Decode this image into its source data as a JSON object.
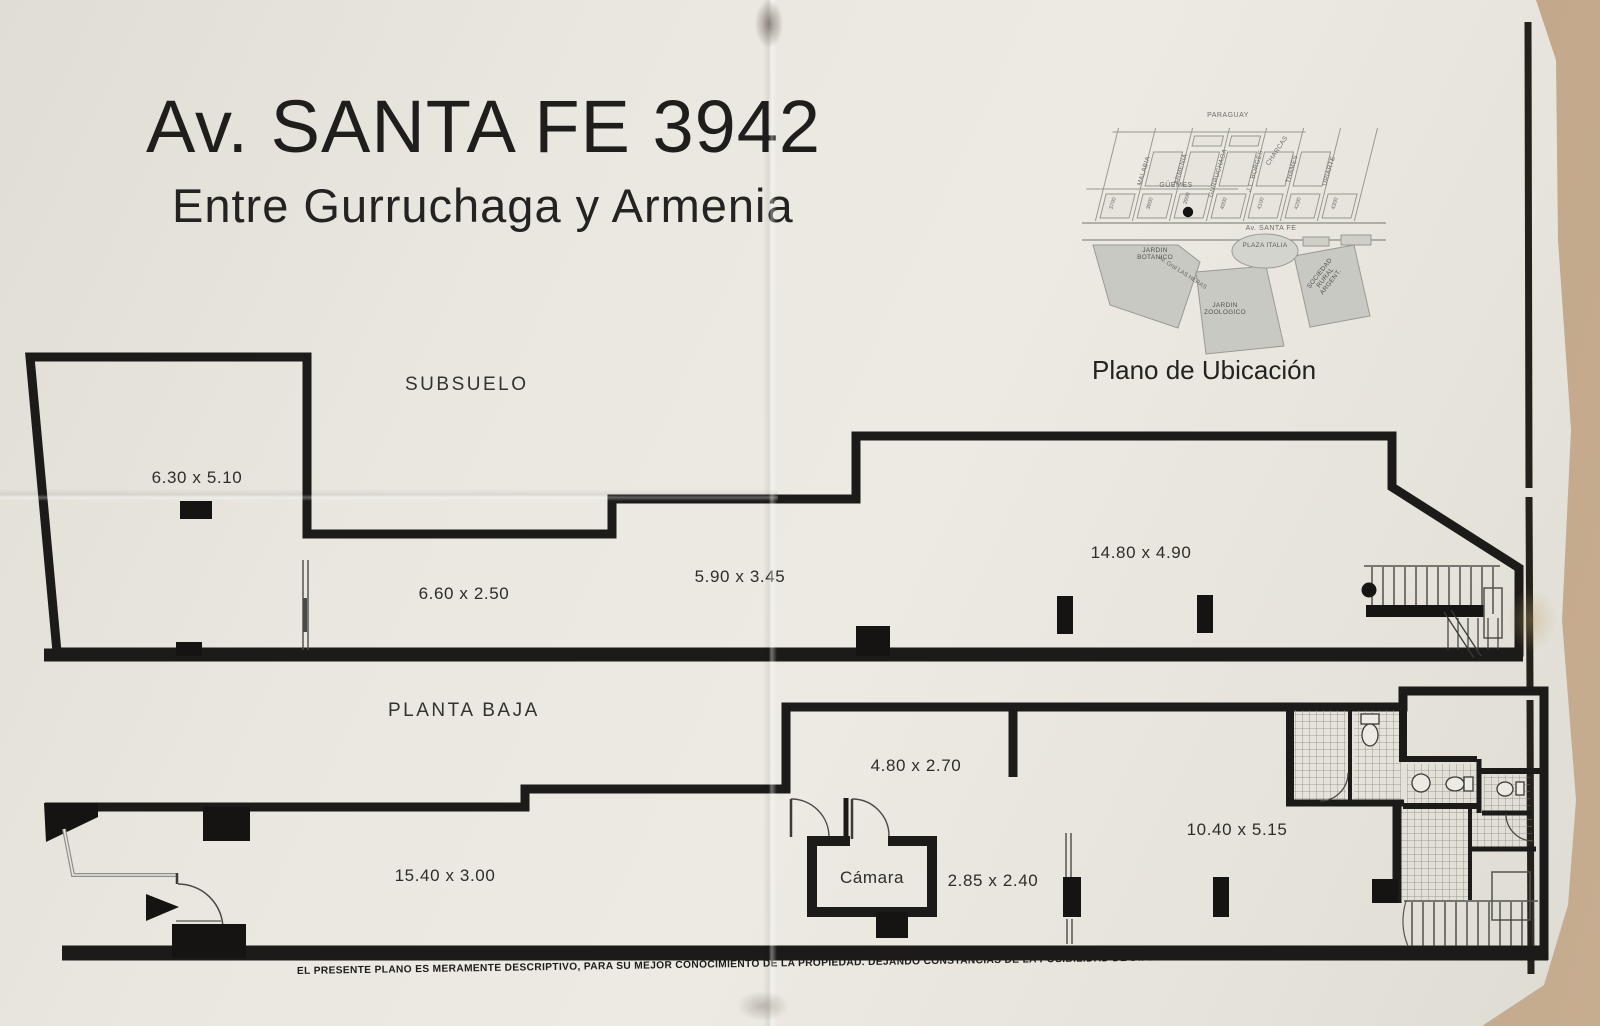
{
  "title": {
    "line1": "Av. SANTA FE 3942",
    "line2": "Entre Gurruchaga y Armenia"
  },
  "map": {
    "caption": "Plano de Ubicación",
    "h_streets": [
      {
        "label": "PARAGUAY"
      },
      {
        "label": "GÜEMES"
      },
      {
        "label": "CHARCAS"
      },
      {
        "label": "Av. SANTA FE"
      }
    ],
    "d_streets": [
      {
        "label": "MALABIA"
      },
      {
        "label": "ARMENIA"
      },
      {
        "label": "GURRUCHAGA"
      },
      {
        "label": "J.L. BORGES"
      },
      {
        "label": "THAMES"
      },
      {
        "label": "URIARTE"
      }
    ],
    "blocks": [
      {
        "num": "3700"
      },
      {
        "num": "3800"
      },
      {
        "num": "3900"
      },
      {
        "num": "4000"
      },
      {
        "num": "4100"
      },
      {
        "num": "4200"
      },
      {
        "num": "4300"
      }
    ],
    "landmarks": {
      "plaza": "PLAZA ITALIA",
      "botanico": "JARDIN BOTANICO",
      "zoologico": "JARDIN ZOOLOGICO",
      "rural": "SOCIEDAD RURAL ARGENT.",
      "las_heras": "Av. Gral LAS HERAS"
    }
  },
  "floors": {
    "subsuelo": {
      "label": "SUBSUELO",
      "dims": [
        {
          "label": "6.30 x 5.10"
        },
        {
          "label": "6.60 x 2.50"
        },
        {
          "label": "5.90 x 3.45"
        },
        {
          "label": "14.80 x 4.90"
        }
      ]
    },
    "planta_baja": {
      "label": "PLANTA BAJA",
      "room": "Cámara",
      "dims": [
        {
          "label": "15.40 x 3.00"
        },
        {
          "label": "4.80 x 2.70"
        },
        {
          "label": "2.85 x 2.40"
        },
        {
          "label": "10.40 x 5.15"
        }
      ]
    }
  },
  "disclaimer": "EL PRESENTE PLANO ES MERAMENTE DESCRIPTIVO, PARA SU MEJOR CONOCIMIENTO DE LA  PROPIEDAD.  DEJANDO CONSTANCIAS DE LA POSIBILIDAD DE DIFERENCIAS CON EL PLANO DE LA PROPIEDAD."
}
